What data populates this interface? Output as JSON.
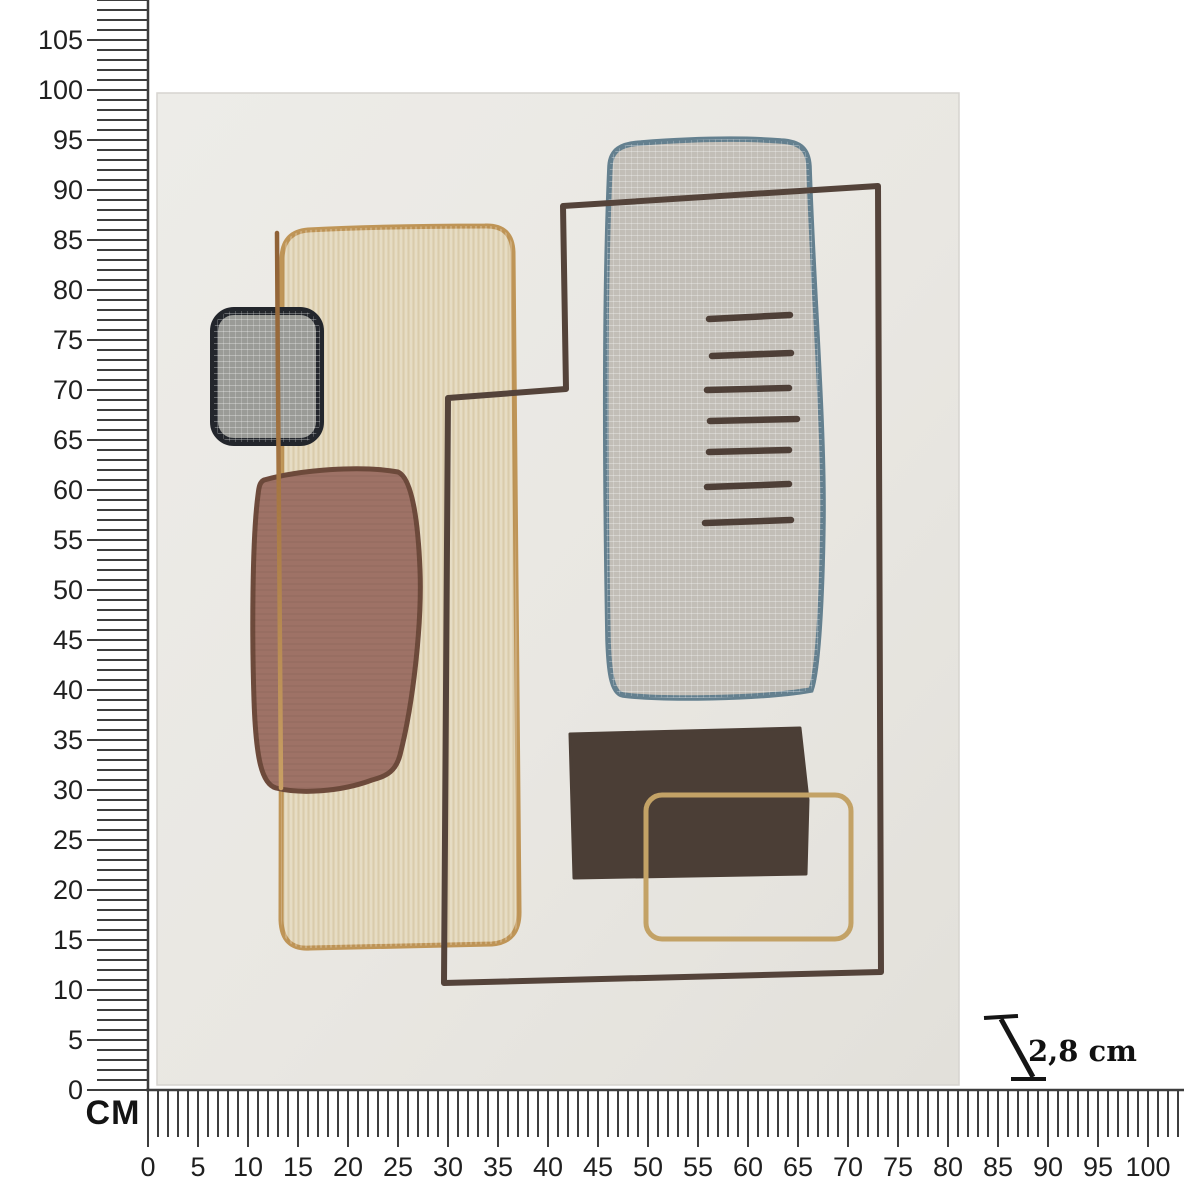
{
  "page": {
    "background": "#ffffff"
  },
  "rulers": {
    "unit_label": "CM",
    "tick_color": "#3d3d3d",
    "label_color": "#1f1f1f",
    "cm_per_tick": 1,
    "label_step_cm": 5,
    "vertical_labels": [
      "0",
      "5",
      "10",
      "15",
      "20",
      "25",
      "30",
      "35",
      "40",
      "45",
      "50",
      "55",
      "60",
      "65",
      "70",
      "75",
      "80",
      "85",
      "90",
      "95",
      "100",
      "105"
    ],
    "horizontal_labels": [
      "0",
      "5",
      "10",
      "15",
      "20",
      "25",
      "30",
      "35",
      "40",
      "45",
      "50",
      "55",
      "60",
      "65",
      "70",
      "75",
      "80",
      "85",
      "90",
      "95",
      "100"
    ]
  },
  "depth_indicator": {
    "label": "2,8 cm"
  },
  "artwork": {
    "approx_width_cm": 80,
    "approx_height_cm": 100,
    "colors": {
      "canvas": "#e9e7e2",
      "beige_fill": "#e0d3b5",
      "beige_outline": "#bf9557",
      "gray_blob_fill": "#c2beb7",
      "gray_blob_outline": "#64808f",
      "square_fill": "#9a9b97",
      "square_outline": "#23262c",
      "mauve_fill": "#9e7266",
      "mauve_outline": "#6d4a3b",
      "dark_rect_fill": "#4b3e36",
      "gold_line": "#c3a266",
      "tan_line": "#aa7a48",
      "brown_line": "#54433a"
    }
  }
}
